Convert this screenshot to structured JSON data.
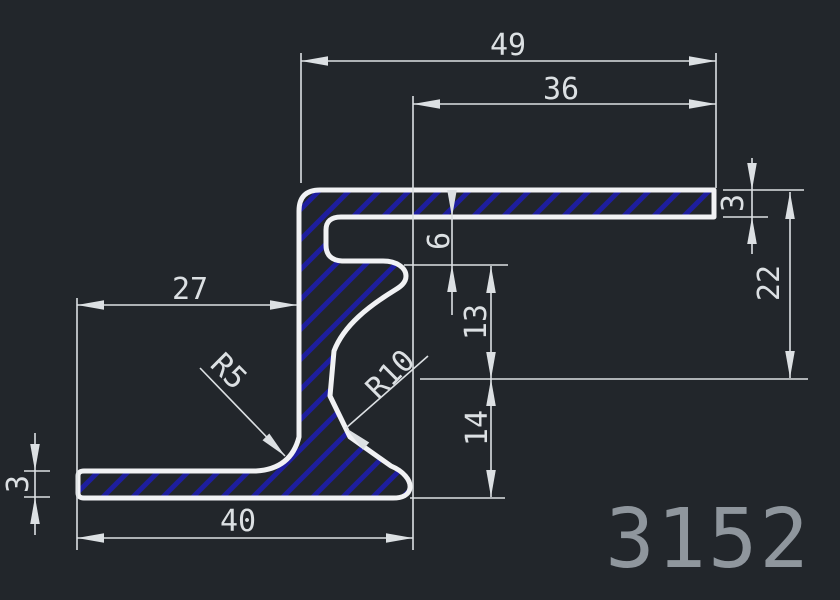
{
  "drawing": {
    "title": "extrusion-profile-section",
    "part_number": "3152",
    "dimensions": {
      "top_width": "49",
      "top_inner_width": "36",
      "left_width": "27",
      "bottom_width": "40",
      "right_height": "22",
      "right_flange_thickness": "3",
      "groove_depth": "6",
      "mid_upper_height": "13",
      "mid_lower_height": "14",
      "left_flange_thickness": "3",
      "fillet_small": "R5",
      "fillet_large": "R10"
    },
    "colors": {
      "background": "#22262b",
      "outline": "#f1f2f4",
      "hatch": "#1e1e9e",
      "dimension": "#dce0e3",
      "part_number_text": "#8f969d"
    }
  }
}
